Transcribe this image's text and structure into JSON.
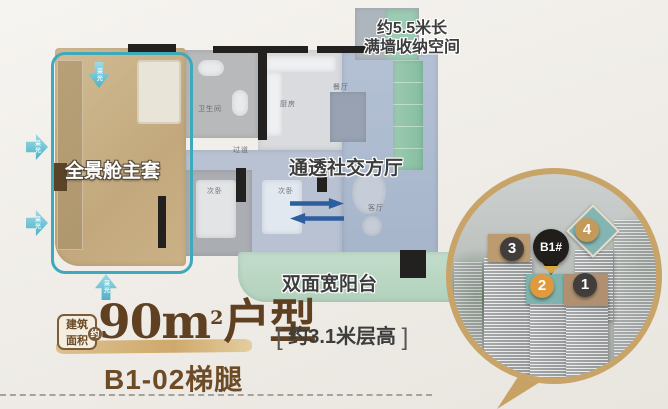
{
  "floor_plan": {
    "storage_label_line1": "约5.5米长",
    "storage_label_line2": "满墙收纳空间",
    "master_suite_label": "全景舱主套",
    "living_label": "通透社交方厅",
    "balcony_label": "双面宽阳台",
    "light_arrow_label": "采光",
    "room_tags": {
      "dining": "餐厅",
      "kitchen": "厨房",
      "bathroom": "卫生间",
      "bedroom_a": "次卧",
      "bedroom_b": "次卧",
      "living": "客厅",
      "passage": "过道"
    }
  },
  "title_block": {
    "area_badge_line1": "建筑",
    "area_badge_line2": "面积",
    "area_badge_circle": "约",
    "area_value": "90m",
    "area_sup": "2",
    "area_suffix": "户型",
    "bracket_open": "[",
    "height_note": "约3.1米层高",
    "bracket_close": "]",
    "unit_code": "B1-02梯腿"
  },
  "inset": {
    "pin_label": "B1#",
    "markers": [
      {
        "label": "3",
        "color": "#413d3a"
      },
      {
        "label": "4",
        "color": "#c49a5a"
      },
      {
        "label": "2",
        "color": "#df9a3e"
      },
      {
        "label": "1",
        "color": "#413d3a"
      }
    ]
  },
  "colors": {
    "accent_gold": "#c8a469",
    "brand_brown": "#6d4b27",
    "teal_outline": "#3fa9bc",
    "swap_blue": "#2d5f9f",
    "balcony_mint": "#bcd7c6",
    "storage_green": "#8cc3a9",
    "master_tan": "#c6ad82",
    "living_blue": "#aebcd0"
  }
}
